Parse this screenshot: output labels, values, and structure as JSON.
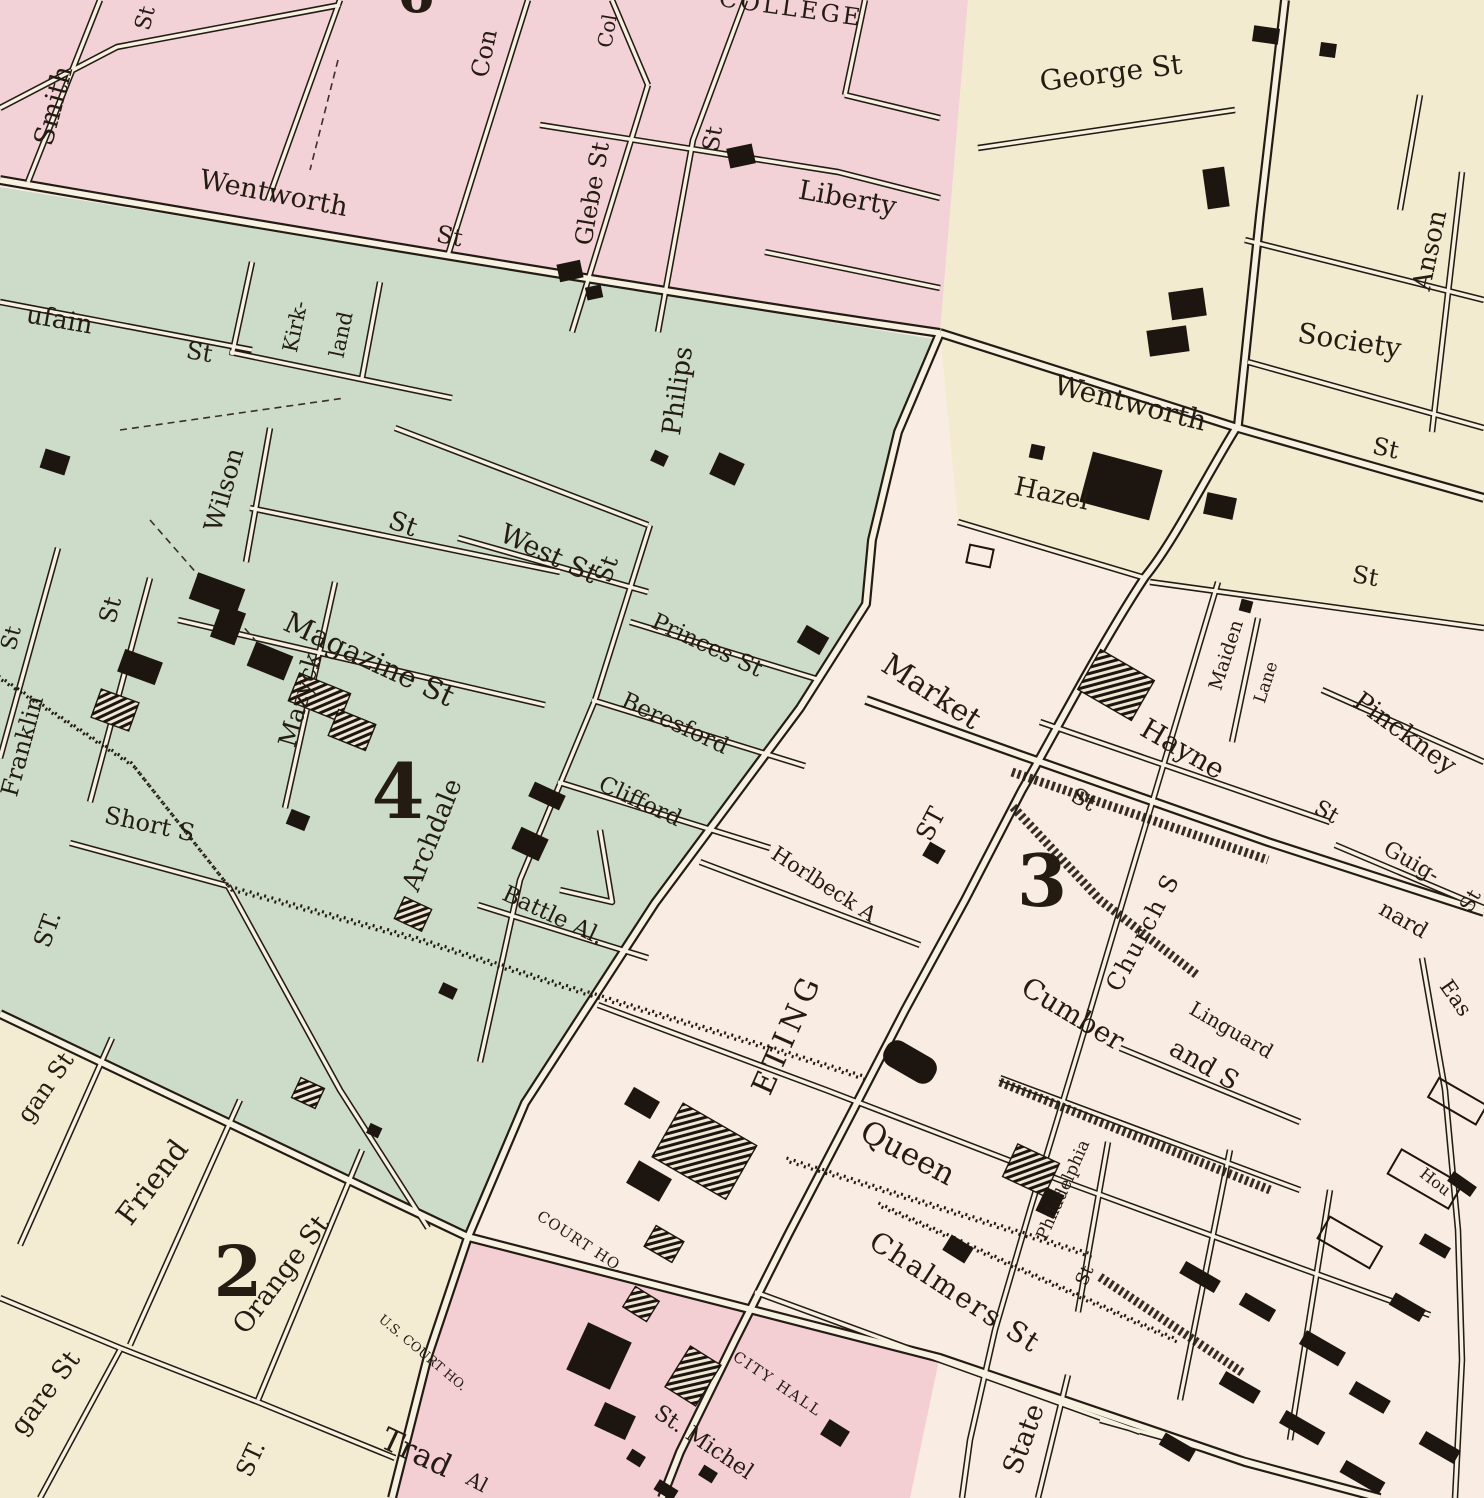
{
  "map": {
    "district_numbers": {
      "d2": "2",
      "d3": "3",
      "d4": "4",
      "d6": "6"
    },
    "labels": {
      "st_topleft": "St",
      "smith": "Smith",
      "wentworth_w": "Wentworth",
      "wentworth_w_st": "St",
      "coming": "Con",
      "college_st": "Col",
      "college": "COLLEGE",
      "glebe": "Glebe St",
      "st_philips_st": "St",
      "st_philips": "Philips",
      "liberty": "Liberty",
      "george": "George St",
      "society": "Society",
      "anson": "Anson",
      "wentworth_e": "Wentworth",
      "wentworth_e_st": "St",
      "hazel": "Hazel",
      "hazel_st": "St",
      "market": "Market",
      "meeting_st": "ST",
      "meeting_eting": "ETING",
      "maiden": "Maiden",
      "lane": "Lane",
      "hayne": "Hayne",
      "hayne_st": "St",
      "pinckney": "Pinckney",
      "market_st2": "St",
      "church": "Church S",
      "guig": "Guig-",
      "nard": "nard",
      "guignard_st": "St",
      "east": "Eas",
      "cumber": "Cumber",
      "and_s": "and S",
      "linguard": "Linguard",
      "queen": "Queen",
      "chalmers": "Chalmers St",
      "horlbeck": "Horlbeck A",
      "philadelphia": "Philadelphia",
      "philadelphia_st": "St",
      "state": "State",
      "hou": "Hou",
      "city_hall": "CITY HALL",
      "st_michel": "St. Michel",
      "michel_al": "Al",
      "court_ho": "COURT HO.",
      "us_court_ho": "U.S. COURT HO.",
      "tradd": "Trad",
      "logan": "gan St",
      "friend": "Friend",
      "orange": "Orange St",
      "legare": "gare St",
      "st_sw": "ST.",
      "beaufain": "ufain",
      "beaufain_st": "St",
      "kirk": "Kirk-",
      "kland": "land",
      "wilson": "Wilson",
      "mazyck_st": "St",
      "magazine": "Magazine St",
      "mazyck": "Mazyck",
      "west": "West St",
      "archdale_st": "St",
      "princes": "Princes St",
      "beresford": "Beresford",
      "clifford": "Clifford",
      "battle": "Battle Al.",
      "archdale": "Archdale",
      "short": "Short S",
      "st_green_s": "ST.",
      "franklin_st": "St",
      "franklin": "Franklin",
      "st_edge": "St"
    },
    "colors": {
      "district_pink": "#f2d2d7",
      "district_green": "#cddcc8",
      "district_cream": "#f2ebd0",
      "district_peach": "#f9ece3",
      "district_pink_south": "#f3cfd4",
      "district_cream_sw": "#f3ecd3",
      "street_core": "#f7f1e2",
      "ink": "#241c14"
    }
  }
}
